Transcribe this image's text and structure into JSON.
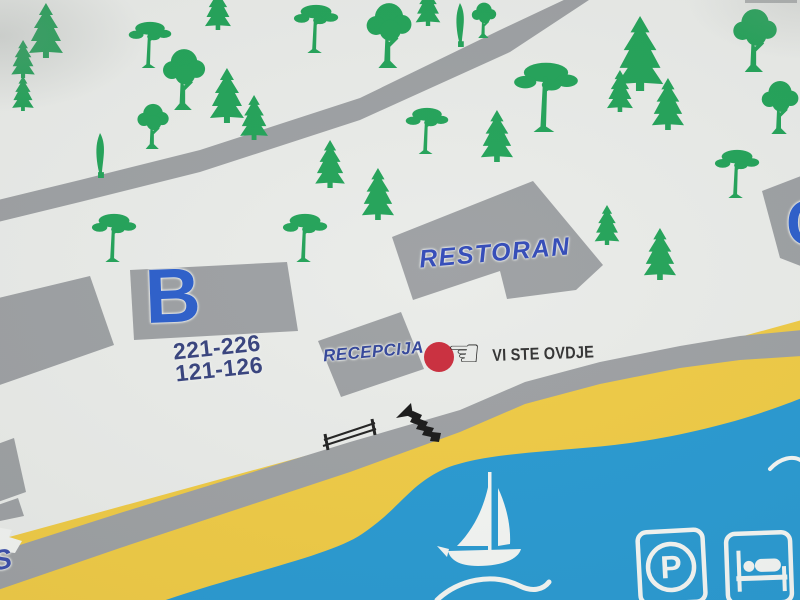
{
  "map": {
    "title": "resort-campsite-orientation-map",
    "buildings": {
      "b": {
        "label": "B",
        "rooms_line1": "221-226",
        "rooms_line2": "121-126"
      },
      "restaurant": {
        "label": "RESTORAN"
      },
      "reception": {
        "label": "RECEPCIJA"
      },
      "c": {
        "label": "C"
      }
    },
    "marker": {
      "label": "VI STE OVDJE"
    },
    "edge_label_s": "S",
    "legend": {
      "parking_letter": "P"
    },
    "icons": {
      "pointing_hand": "☜",
      "you_are_here_dot": "red-circle",
      "sailboat": "white-svg-shape",
      "parking": "rounded-square-P",
      "lodging_bed": "rounded-square-bed",
      "stairs": "black-steps-arrow",
      "bench": "black-rail-lines",
      "wave": "white-arc",
      "trees": [
        "fir-tree",
        "pine-tree",
        "cypress-tree",
        "deciduous-tree"
      ]
    },
    "colors": {
      "background": "#e9ebe8",
      "building_gray": "#9a9da0",
      "road_gray": "#9a9da0",
      "beach_yellow": "#efc93e",
      "sea_blue": "#2196d0",
      "tree_green": "#1ba053",
      "label_blue": "#2559c9",
      "navy_text": "#303c79",
      "marker_red": "#c82636",
      "dark_text": "#2b2b2b"
    },
    "trees": [
      {
        "type": "fir",
        "x": 46,
        "y": 3,
        "h": 55
      },
      {
        "type": "fir",
        "x": 23,
        "y": 40,
        "h": 38
      },
      {
        "type": "fir",
        "x": 23,
        "y": 76,
        "h": 35
      },
      {
        "type": "pine",
        "x": 150,
        "y": 20,
        "h": 48
      },
      {
        "type": "dec",
        "x": 184,
        "y": 48,
        "h": 62
      },
      {
        "type": "fir",
        "x": 218,
        "y": -12,
        "h": 42
      },
      {
        "type": "fir",
        "x": 227,
        "y": 68,
        "h": 55
      },
      {
        "type": "fir",
        "x": 254,
        "y": 95,
        "h": 45
      },
      {
        "type": "cyp",
        "x": 100,
        "y": 133,
        "h": 45
      },
      {
        "type": "dec",
        "x": 153,
        "y": 103,
        "h": 46
      },
      {
        "type": "pine",
        "x": 316,
        "y": 3,
        "h": 50
      },
      {
        "type": "dec",
        "x": 389,
        "y": 2,
        "h": 66
      },
      {
        "type": "cyp",
        "x": 460,
        "y": 3,
        "h": 44
      },
      {
        "type": "dec",
        "x": 484,
        "y": 2,
        "h": 36
      },
      {
        "type": "fir",
        "x": 428,
        "y": -14,
        "h": 40
      },
      {
        "type": "fir",
        "x": 330,
        "y": 140,
        "h": 48
      },
      {
        "type": "fir",
        "x": 378,
        "y": 168,
        "h": 52
      },
      {
        "type": "pine",
        "x": 427,
        "y": 106,
        "h": 48
      },
      {
        "type": "fir",
        "x": 497,
        "y": 110,
        "h": 52
      },
      {
        "type": "pine",
        "x": 114,
        "y": 212,
        "h": 50
      },
      {
        "type": "pine",
        "x": 305,
        "y": 212,
        "h": 50
      },
      {
        "type": "pine",
        "x": 546,
        "y": 60,
        "h": 72
      },
      {
        "type": "fir",
        "x": 640,
        "y": 16,
        "h": 75
      },
      {
        "type": "fir",
        "x": 620,
        "y": 70,
        "h": 42
      },
      {
        "type": "fir",
        "x": 668,
        "y": 78,
        "h": 52
      },
      {
        "type": "dec",
        "x": 755,
        "y": 8,
        "h": 64
      },
      {
        "type": "dec",
        "x": 780,
        "y": 80,
        "h": 54
      },
      {
        "type": "pine",
        "x": 737,
        "y": 148,
        "h": 50
      },
      {
        "type": "fir",
        "x": 660,
        "y": 228,
        "h": 52
      },
      {
        "type": "fir",
        "x": 607,
        "y": 205,
        "h": 40
      }
    ]
  }
}
